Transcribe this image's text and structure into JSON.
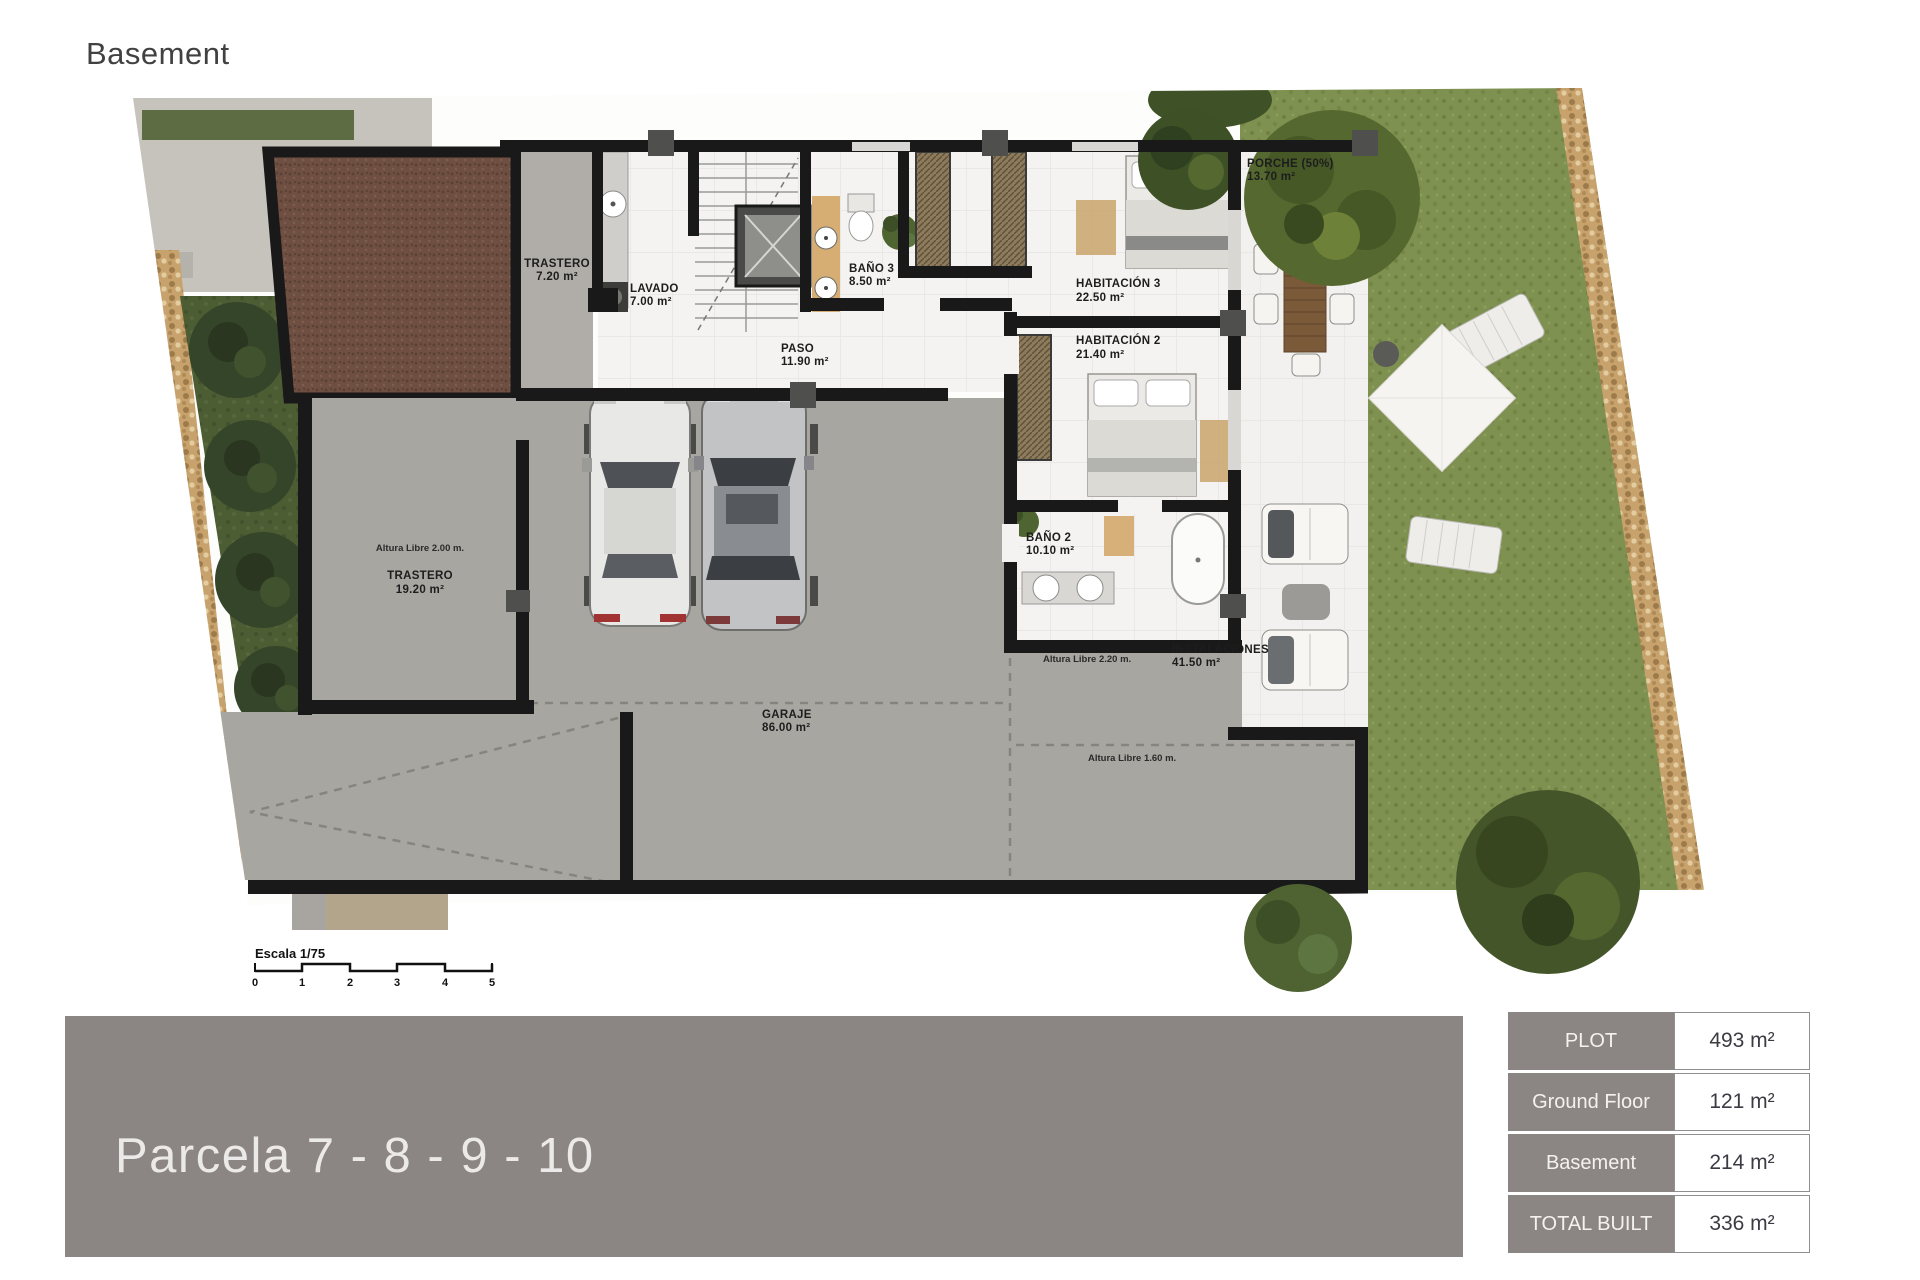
{
  "page": {
    "title": "Basement"
  },
  "plan": {
    "rooms": [
      {
        "name": "TRASTERO",
        "area": "7.20 m²"
      },
      {
        "name": "LAVADO",
        "area": "7.00 m²"
      },
      {
        "name": "BAÑO 3",
        "area": "8.50 m²"
      },
      {
        "name": "PASO",
        "area": "11.90 m²"
      },
      {
        "name": "HABITACIÓN 3",
        "area": "22.50 m²"
      },
      {
        "name": "HABITACIÓN 2",
        "area": "21.40 m²"
      },
      {
        "name": "PORCHE (50%)",
        "area": "13.70 m²"
      },
      {
        "name": "BAÑO 2",
        "area": "10.10 m²"
      },
      {
        "name": "TRASTERO",
        "area": "19.20 m²"
      },
      {
        "name": "GARAJE",
        "area": "86.00 m²"
      },
      {
        "name": "INSTALACIONES",
        "area": "41.50 m²"
      }
    ],
    "notes": [
      {
        "text": "Altura Libre 2.00 m."
      },
      {
        "text": "Altura Libre 2.20 m."
      },
      {
        "text": "Altura Libre 1.60 m."
      }
    ],
    "scale": {
      "label": "Escala 1/75",
      "ticks": [
        "0",
        "1",
        "2",
        "3",
        "4",
        "5"
      ]
    }
  },
  "banner": {
    "title": "Parcela 7 - 8 - 9  - 10"
  },
  "summary": {
    "rows": [
      {
        "label": "PLOT",
        "value": "493 m²"
      },
      {
        "label": "Ground Floor",
        "value": "121 m²"
      },
      {
        "label": "Basement",
        "value": "214 m²"
      },
      {
        "label": "TOTAL BUILT",
        "value": "336 m²"
      }
    ]
  },
  "colors": {
    "banner_gray": "#8b8583",
    "wall_black": "#191919",
    "floor_white": "#f4f3f1",
    "garage_gray": "#a8a6a1",
    "grass_green": "#7f9150",
    "patio_brown": "#6e4f41",
    "pebble_tan": "#c8a26d",
    "wood_tan": "#d4a96c"
  }
}
